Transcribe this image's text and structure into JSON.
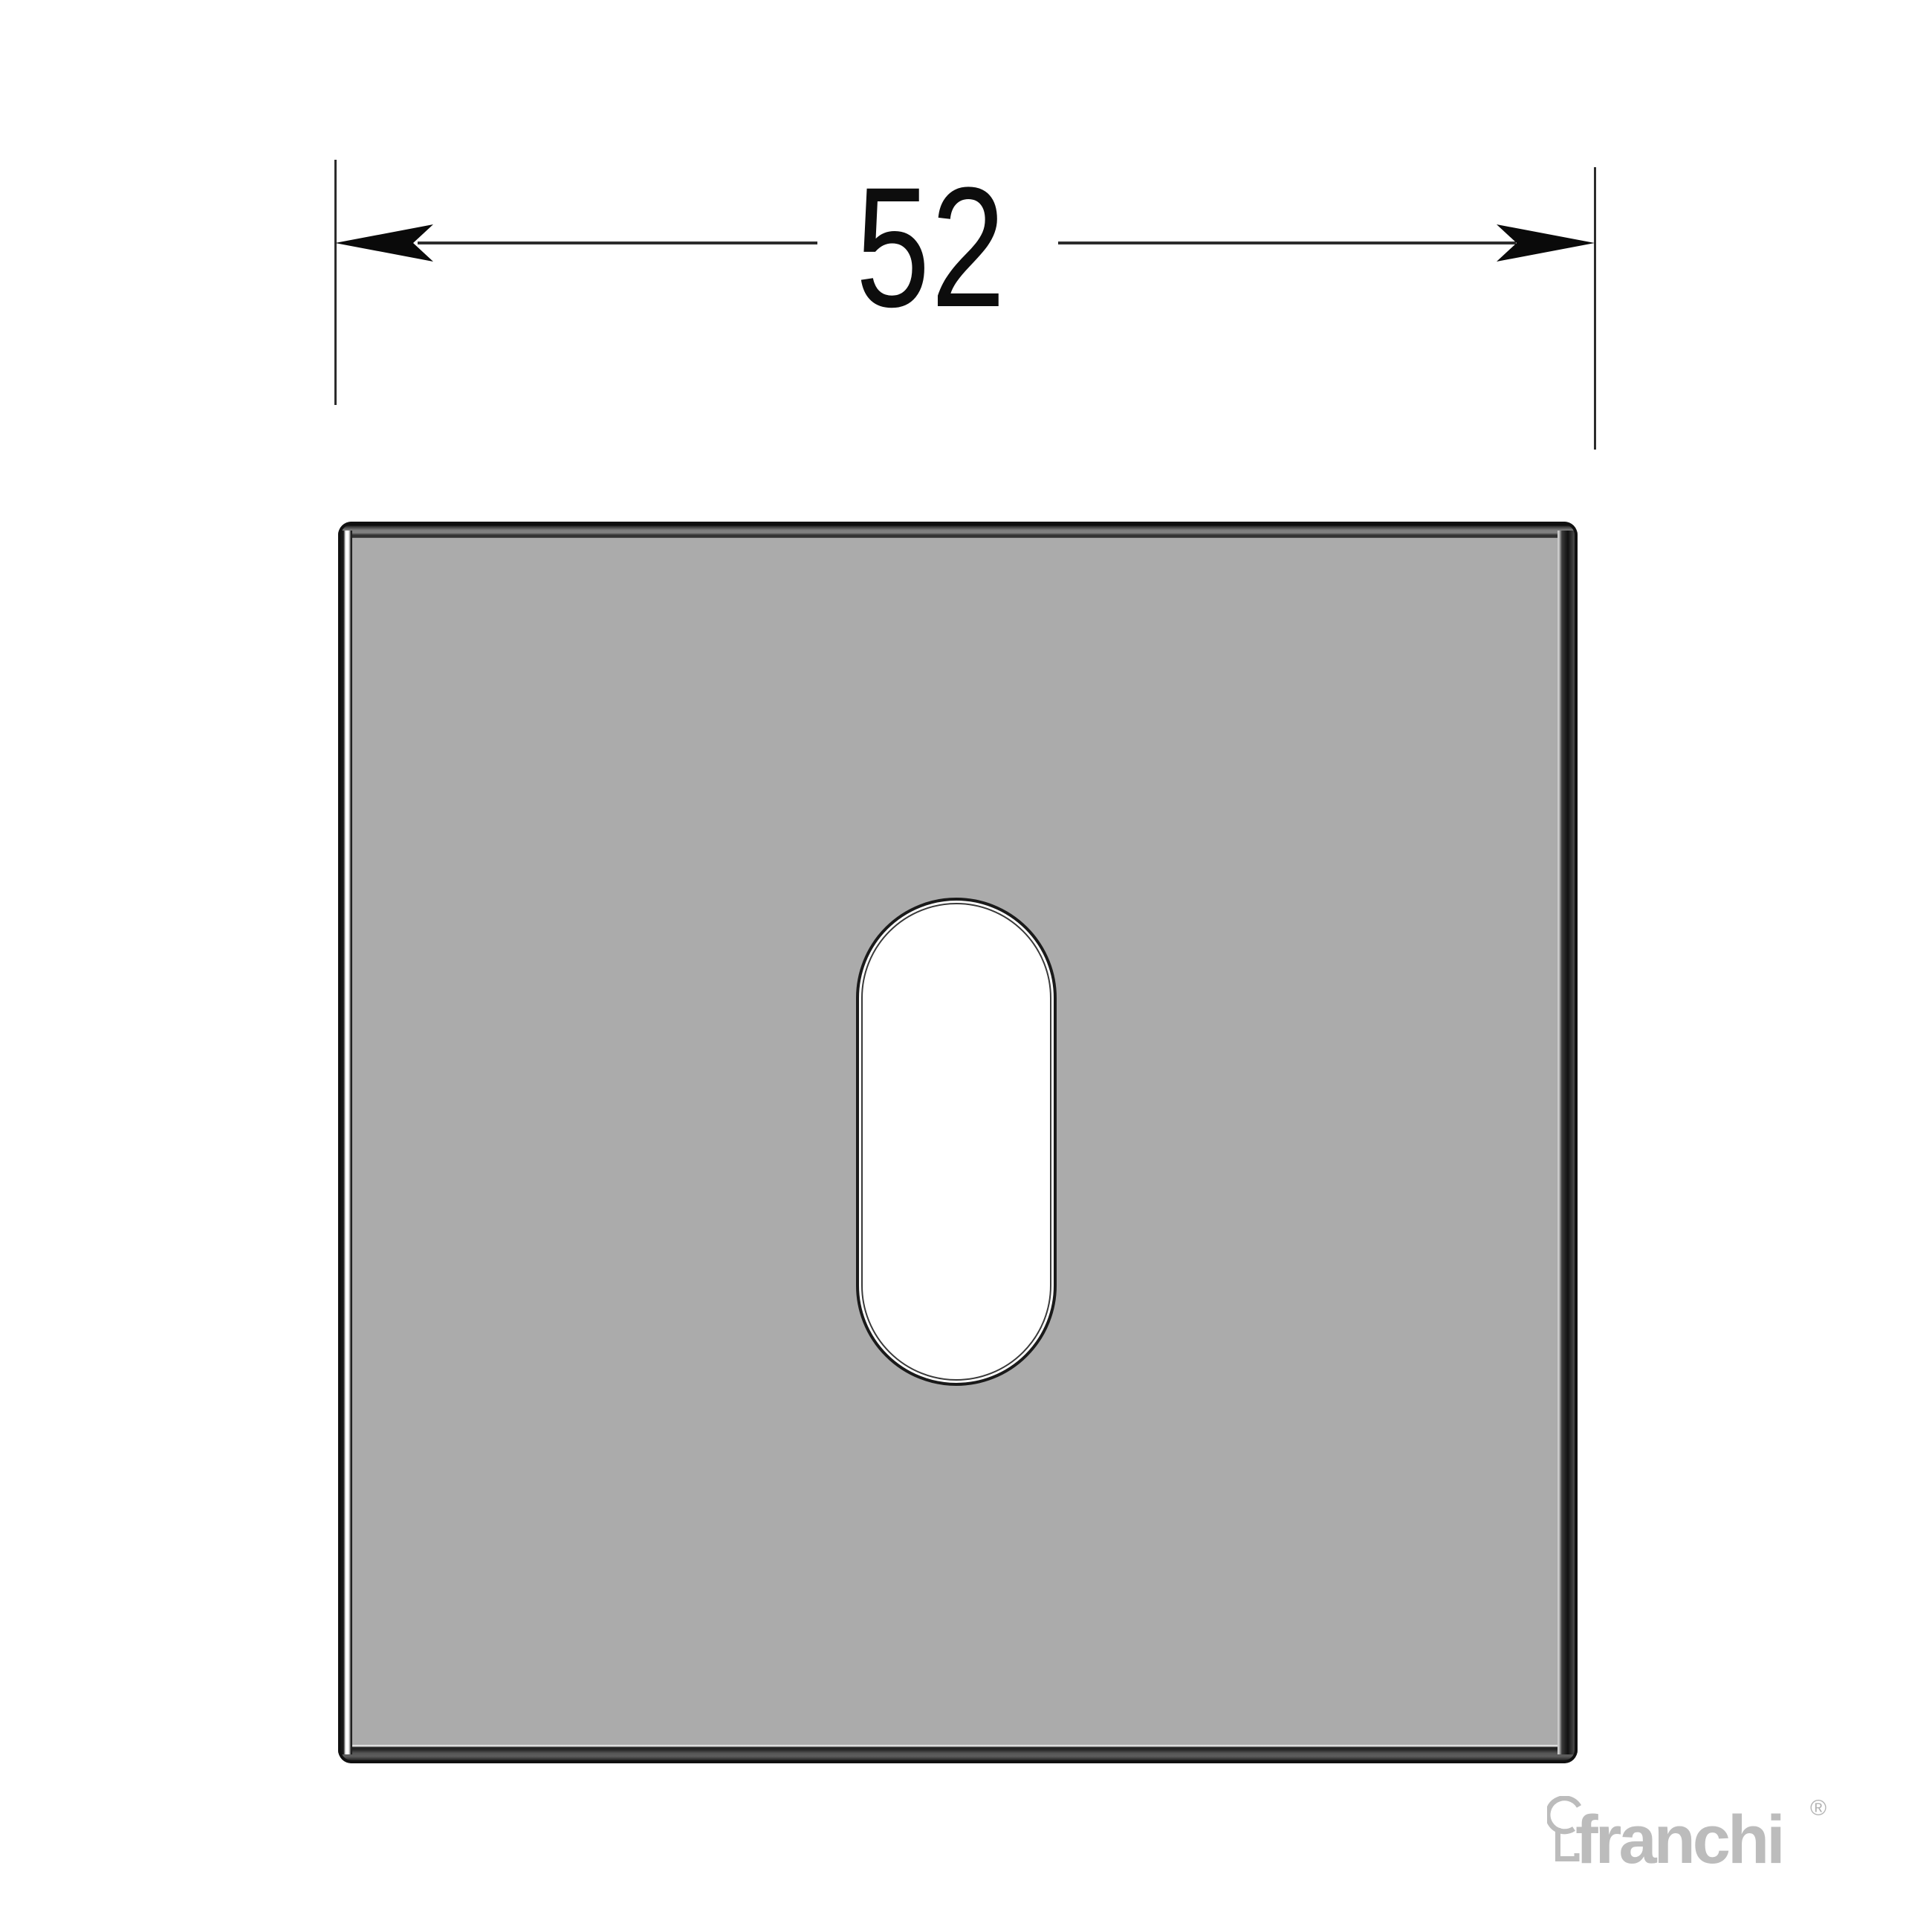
{
  "drawing": {
    "type": "technical-drawing",
    "subject": "square escutcheon plate with oval keyhole slot, front view"
  },
  "dimension": {
    "value": "52"
  },
  "logo": {
    "brand": "franchi",
    "registered_mark": "®"
  },
  "icons": {
    "dimension-arrow-left-icon": "solid CAD arrowhead pointing left",
    "dimension-arrow-right-icon": "solid CAD arrowhead pointing right",
    "keyhole-logo-icon": "outlined keyhole glyph of brand logo"
  },
  "colors": {
    "background": "#ffffff",
    "plate_fill": "#ababab",
    "plate_outline": "#101010",
    "plate_highlight": "#ffffff",
    "slot_fill": "#ffffff",
    "dimension_lines": "#2c2c2c",
    "dimension_text": "#0d0d0d",
    "logo_gray": "#bcbcbc"
  }
}
